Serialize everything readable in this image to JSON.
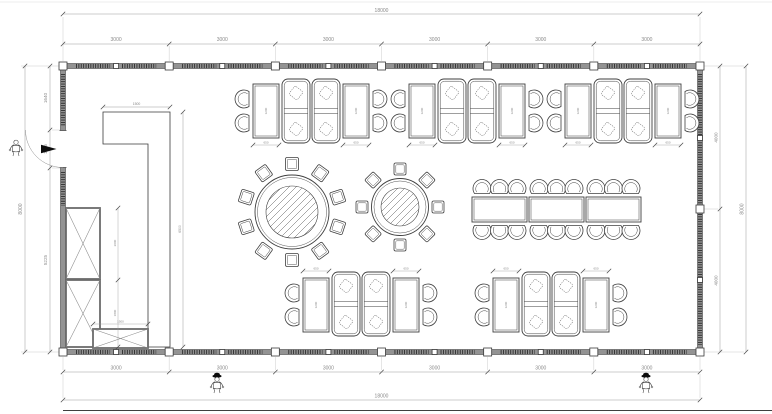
{
  "title": "Restaurant dining hall furniture layout plan",
  "drawing": {
    "type": "architectural-floor-plan",
    "units": "mm",
    "building": {
      "width": "18000",
      "depth": "8000",
      "bays": 6
    },
    "dimensions": {
      "top": {
        "overall": "18000",
        "segments": [
          "3000",
          "3000",
          "3000",
          "3000",
          "3000",
          "3000"
        ]
      },
      "bottom": {
        "overall": "18000",
        "segments": [
          "3000",
          "3000",
          "3000",
          "3000",
          "3000",
          "3000"
        ]
      },
      "left": {
        "overall": "8000",
        "segments": [
          "1640",
          "1135",
          "5225"
        ]
      },
      "right": {
        "overall": "8000",
        "segments": [
          "4000",
          "4000"
        ]
      },
      "counter_length": "1500",
      "counter_run": "6500",
      "cabinet_upper": "2000",
      "cabinet_lower": "1800",
      "cabinet_width": "1500",
      "table_width": "650",
      "table_length": "1200"
    },
    "furniture": {
      "round_table_large_seats": 10,
      "round_table_small_seats": 8,
      "banquet_tables": 3,
      "banquet_seats_per_table": 6,
      "top_row_groups": 3,
      "bottom_row_groups": 2,
      "booths_per_group": 2,
      "two_seat_tables_per_group": 2
    },
    "colors": {
      "background": "#ffffff",
      "wall_fill": "#939393",
      "line": "#3f3f3f",
      "dimension": "#8a8a8a"
    }
  }
}
